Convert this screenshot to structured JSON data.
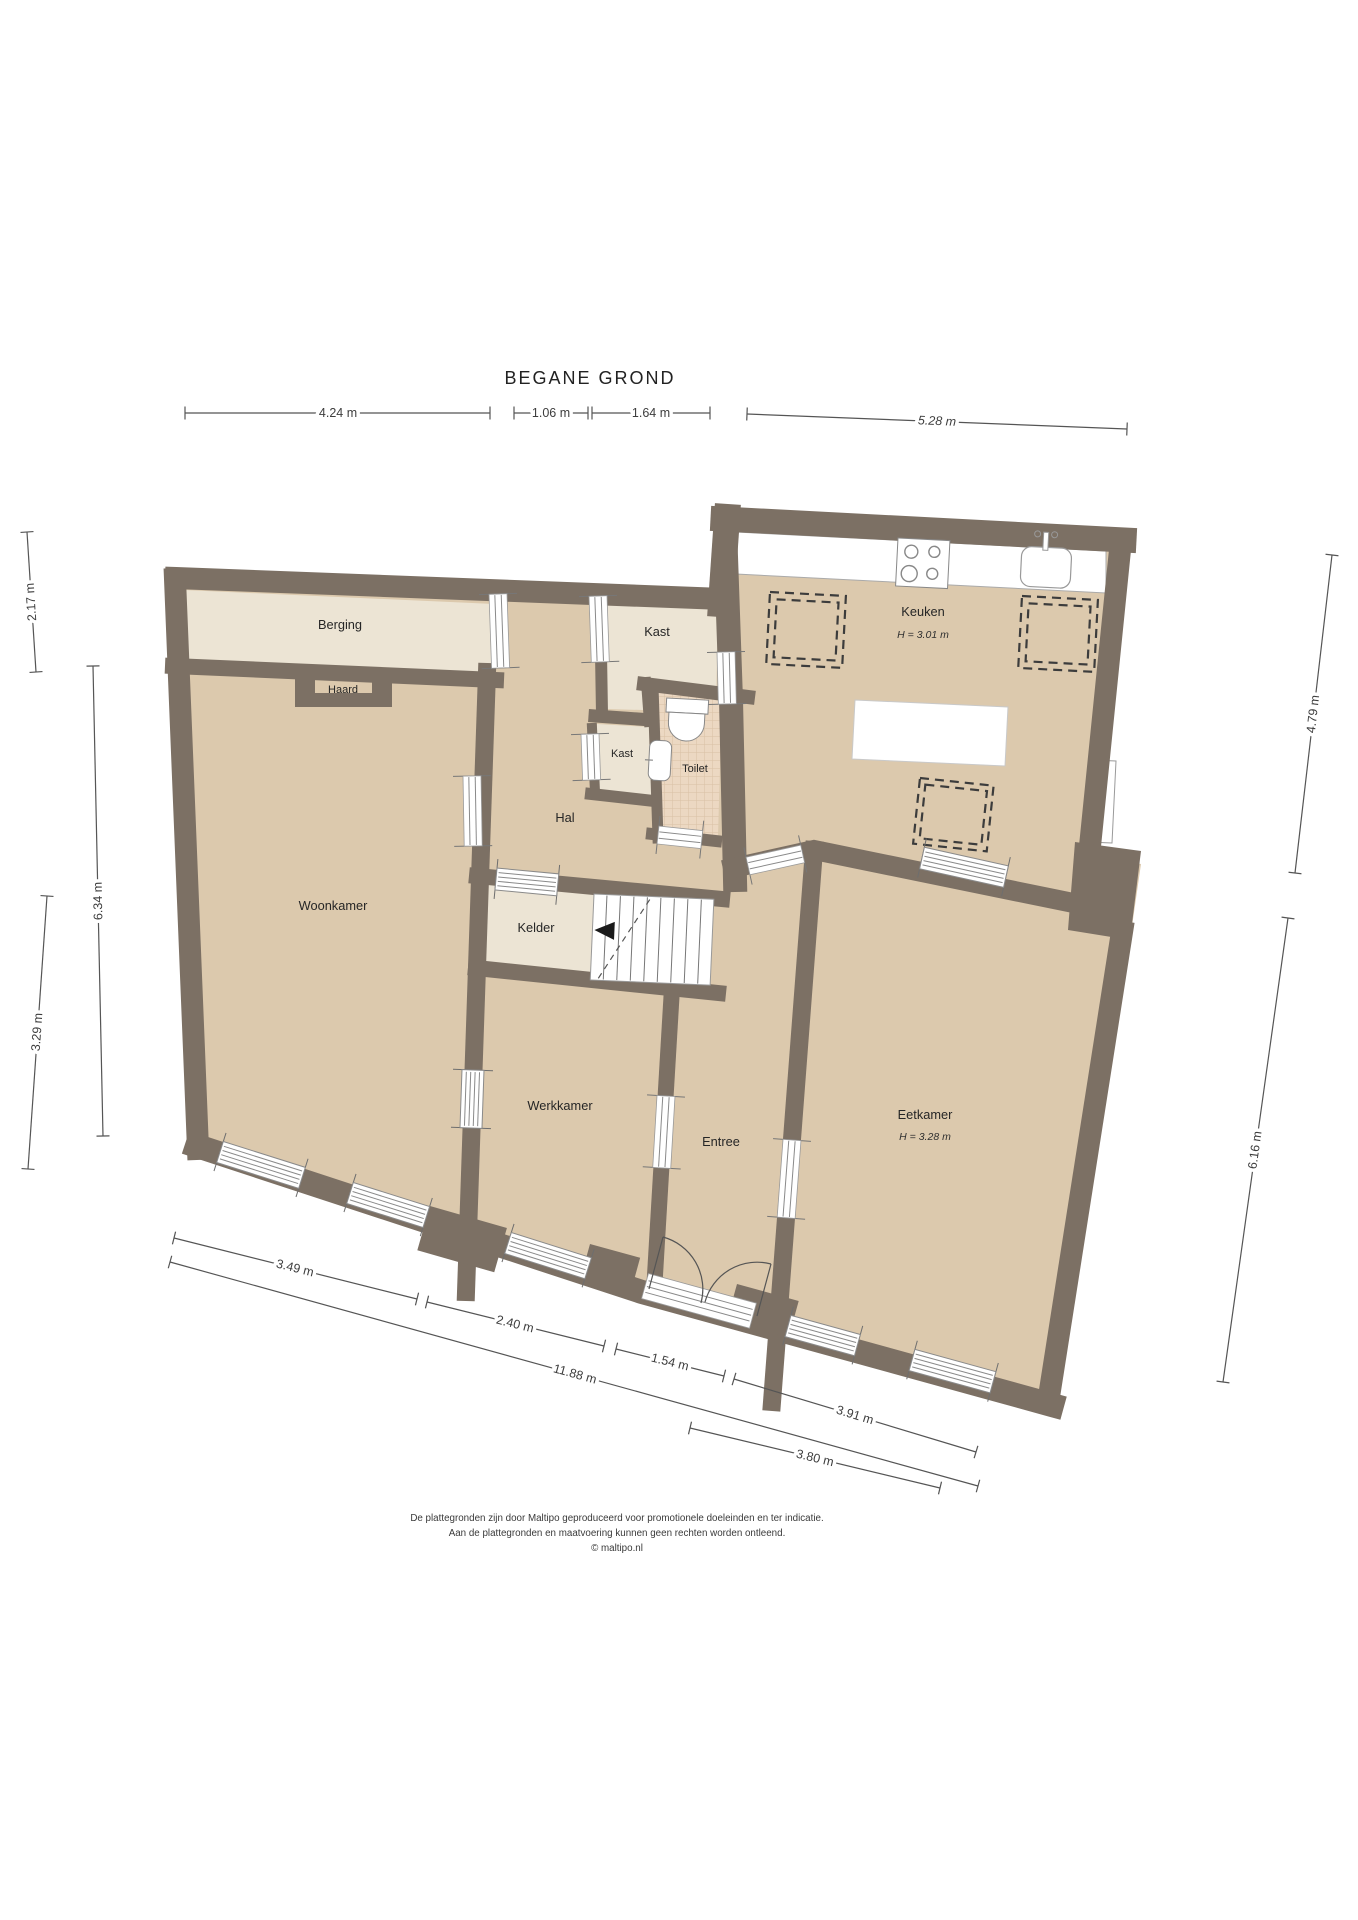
{
  "title": "BEGANE GROND",
  "rooms": {
    "berging": {
      "label": "Berging"
    },
    "haard": {
      "label": "Haard"
    },
    "kast_boven": {
      "label": "Kast"
    },
    "kast_onder": {
      "label": "Kast"
    },
    "toilet": {
      "label": "Toilet"
    },
    "hal": {
      "label": "Hal"
    },
    "keuken": {
      "label": "Keuken",
      "height": "H = 3.01 m"
    },
    "woonkamer": {
      "label": "Woonkamer"
    },
    "kelder": {
      "label": "Kelder"
    },
    "werkkamer": {
      "label": "Werkkamer"
    },
    "entree": {
      "label": "Entree"
    },
    "eetkamer": {
      "label": "Eetkamer",
      "height": "H = 3.28 m"
    }
  },
  "dimensions": {
    "top": [
      "4.24 m",
      "1.06 m",
      "1.64 m",
      "5.28 m"
    ],
    "left": [
      "2.17 m",
      "6.34 m",
      "3.29 m"
    ],
    "right": [
      "4.79 m",
      "6.16 m"
    ],
    "bottom": [
      "3.49 m",
      "2.40 m",
      "1.54 m",
      "11.88 m",
      "3.91 m",
      "3.80 m"
    ]
  },
  "footer": {
    "line1": "De plattegronden zijn door Maltipo geproduceerd voor promotionele doeleinden en ter indicatie.",
    "line2": "Aan de plattegronden en maatvoering kunnen geen rechten worden ontleend.",
    "line3": "© maltipo.nl"
  },
  "icons": [
    "stove-icon",
    "sink-icon",
    "toilet-icon",
    "basin-icon",
    "stairs-icon",
    "fireplace-icon",
    "front-door-icon"
  ],
  "colors": {
    "wall": "#7c7064",
    "floor": "#dcc9ad",
    "floor_light": "#ece4d4",
    "tile": "#ecd8c2",
    "accent_white": "#ffffff"
  }
}
